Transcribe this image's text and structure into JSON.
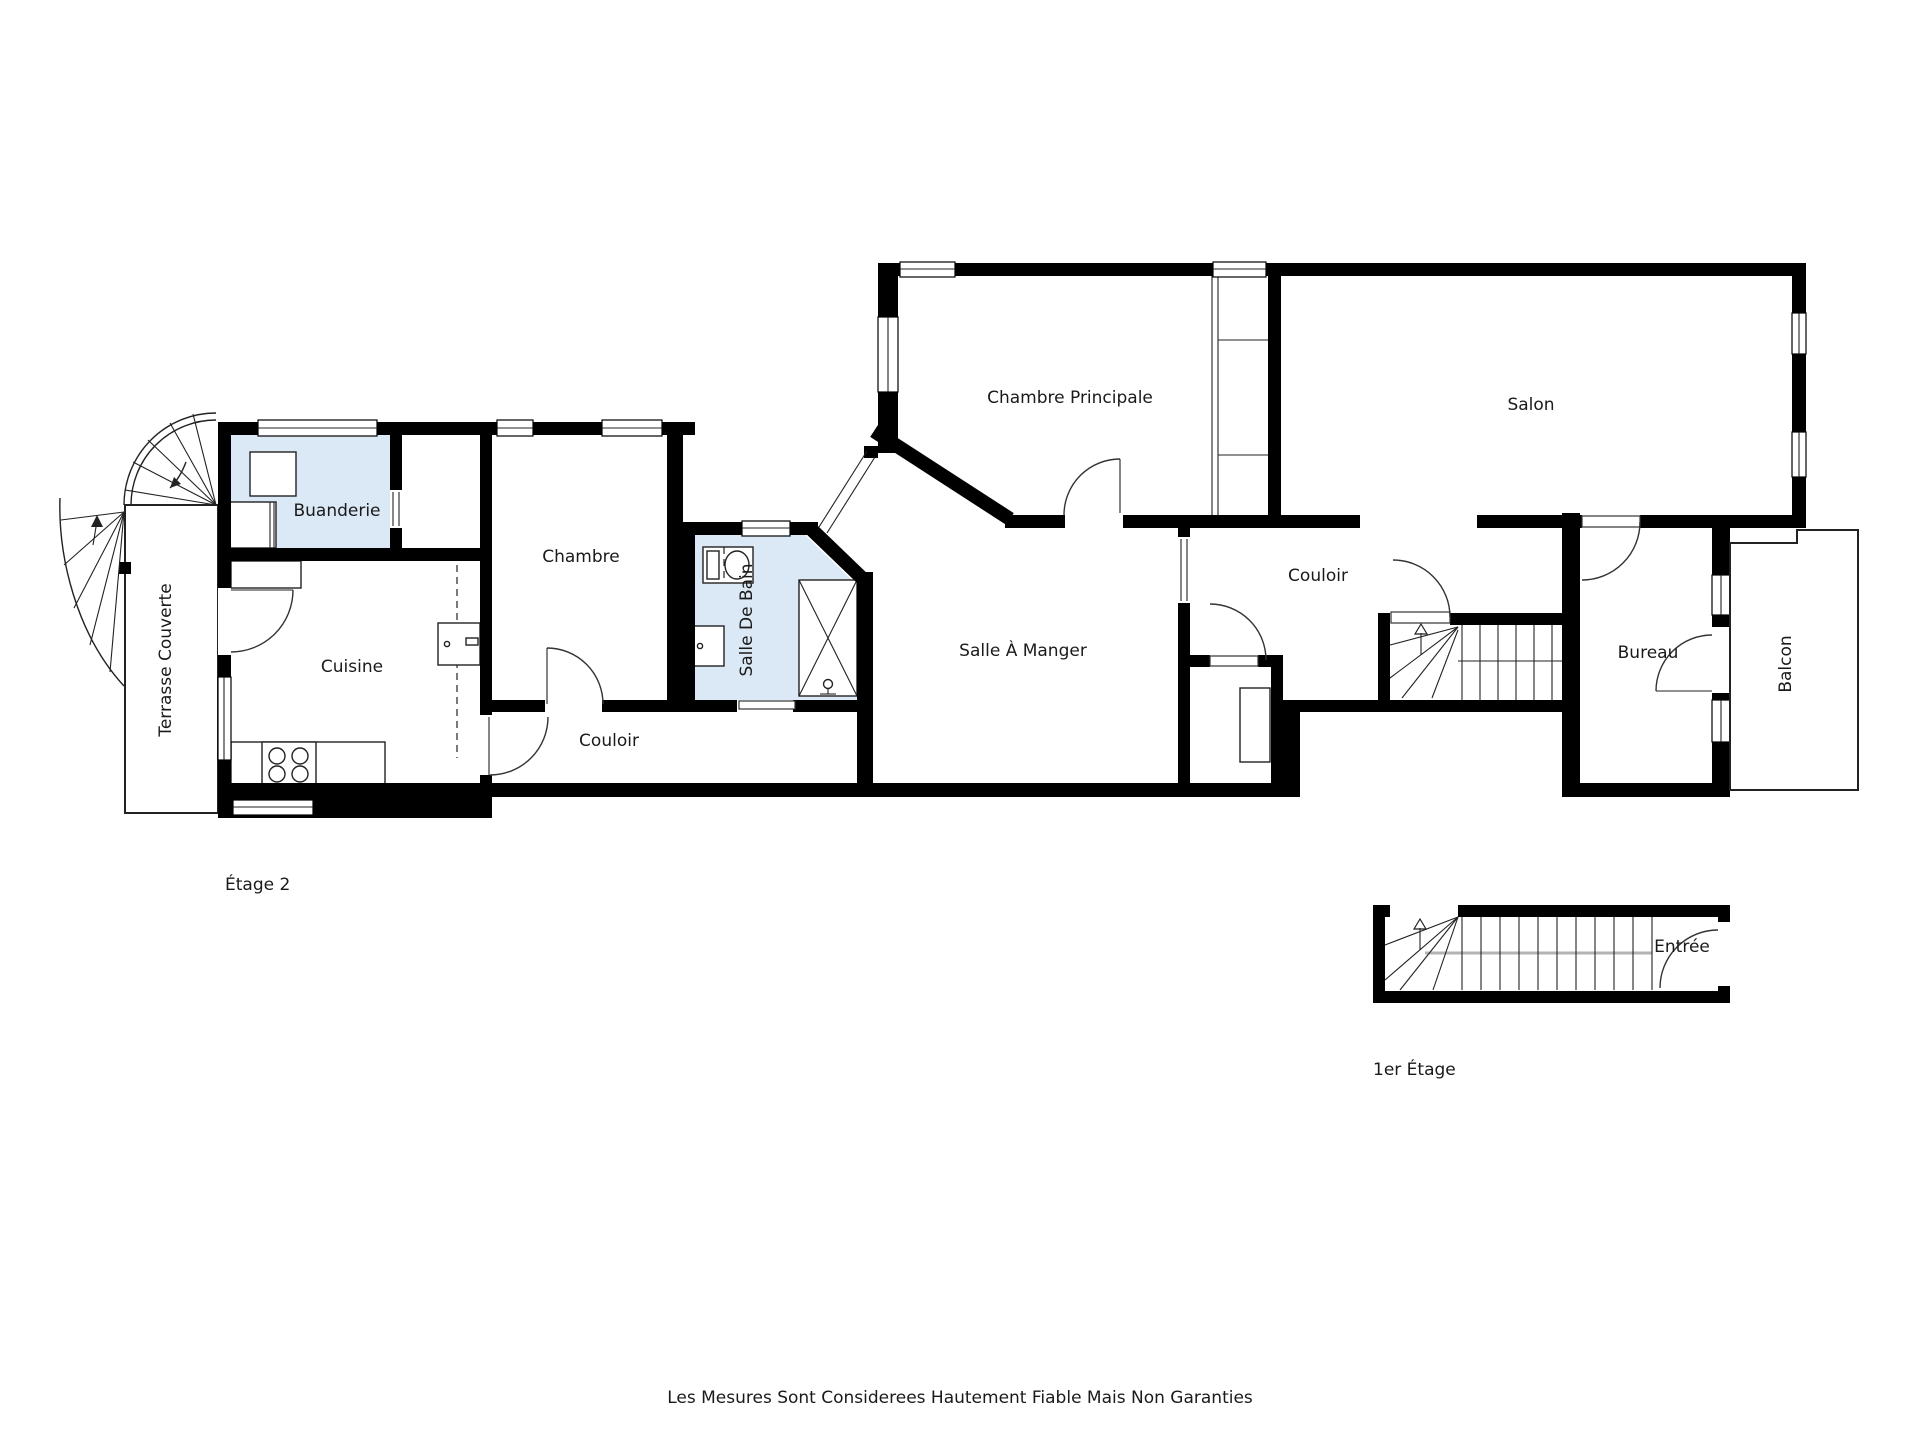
{
  "floorplan": {
    "labels": {
      "chambre_principale": "Chambre Principale",
      "salon": "Salon",
      "buanderie": "Buanderie",
      "chambre": "Chambre",
      "salle_de_bain": "Salle De Bain",
      "terrasse_couverte": "Terrasse Couverte",
      "cuisine": "Cuisine",
      "couloir_left": "Couloir",
      "salle_a_manger": "Salle À Manger",
      "couloir_right": "Couloir",
      "bureau": "Bureau",
      "balcon": "Balcon",
      "etage2": "Étage 2",
      "entree": "Entrée",
      "premier_etage": "1er Étage",
      "disclaimer": "Les Mesures Sont Considerees Hautement Fiable Mais Non Garanties"
    },
    "colors": {
      "wall": "#000000",
      "wet_room_fill": "#dbe8f5",
      "floor_fill": "#ffffff",
      "text": "#1a1a1a"
    }
  }
}
